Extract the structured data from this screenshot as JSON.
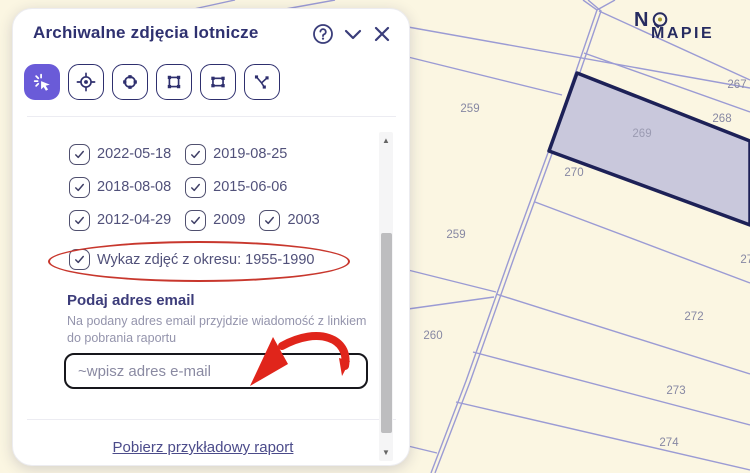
{
  "brand": {
    "line1": "N",
    "line2": "MAPIE"
  },
  "panel": {
    "title": "Archiwalne zdjęcia lotnicze",
    "tools": [
      {
        "name": "select-click",
        "active": true
      },
      {
        "name": "locate-point",
        "active": false
      },
      {
        "name": "edit-circle",
        "active": false
      },
      {
        "name": "draw-rectangle",
        "active": false
      },
      {
        "name": "transform-shape",
        "active": false
      },
      {
        "name": "draw-polyline",
        "active": false
      }
    ],
    "date_rows": [
      [
        "2022-05-18",
        "2019-08-25"
      ],
      [
        "2018-08-08",
        "2015-06-06"
      ],
      [
        "2012-04-29",
        "2009",
        "2003"
      ]
    ],
    "report_option": {
      "label": "Wykaz zdjęć z okresu: 1955-1990",
      "checked": true
    },
    "email": {
      "heading": "Podaj adres email",
      "description": "Na podany adres email przyjdzie wiadomość z linkiem do pobrania raportu",
      "placeholder": "~wpisz adres e-mail",
      "value": ""
    },
    "footer_link": "Pobierz przykładowy raport"
  },
  "map": {
    "selected_parcel": "269",
    "labels": [
      {
        "text": "259",
        "x": 470,
        "y": 112
      },
      {
        "text": "267",
        "x": 737,
        "y": 88
      },
      {
        "text": "268",
        "x": 722,
        "y": 122
      },
      {
        "text": "269",
        "x": 642,
        "y": 137,
        "selected": true
      },
      {
        "text": "270",
        "x": 574,
        "y": 176
      },
      {
        "text": "259",
        "x": 456,
        "y": 238
      },
      {
        "text": "271",
        "x": 750,
        "y": 263
      },
      {
        "text": "260",
        "x": 433,
        "y": 339
      },
      {
        "text": "272",
        "x": 694,
        "y": 320
      },
      {
        "text": "273",
        "x": 676,
        "y": 394
      },
      {
        "text": "274",
        "x": 669,
        "y": 446
      }
    ],
    "colors": {
      "background": "#FBF6E2",
      "boundary": "#9B9BD4",
      "selected_fill": "#C9C8DC",
      "selected_border": "#1D2157",
      "label": "#8788A3"
    }
  },
  "annotations": {
    "highlight_color": "#C8372D",
    "arrow_color": "#E0251B"
  }
}
